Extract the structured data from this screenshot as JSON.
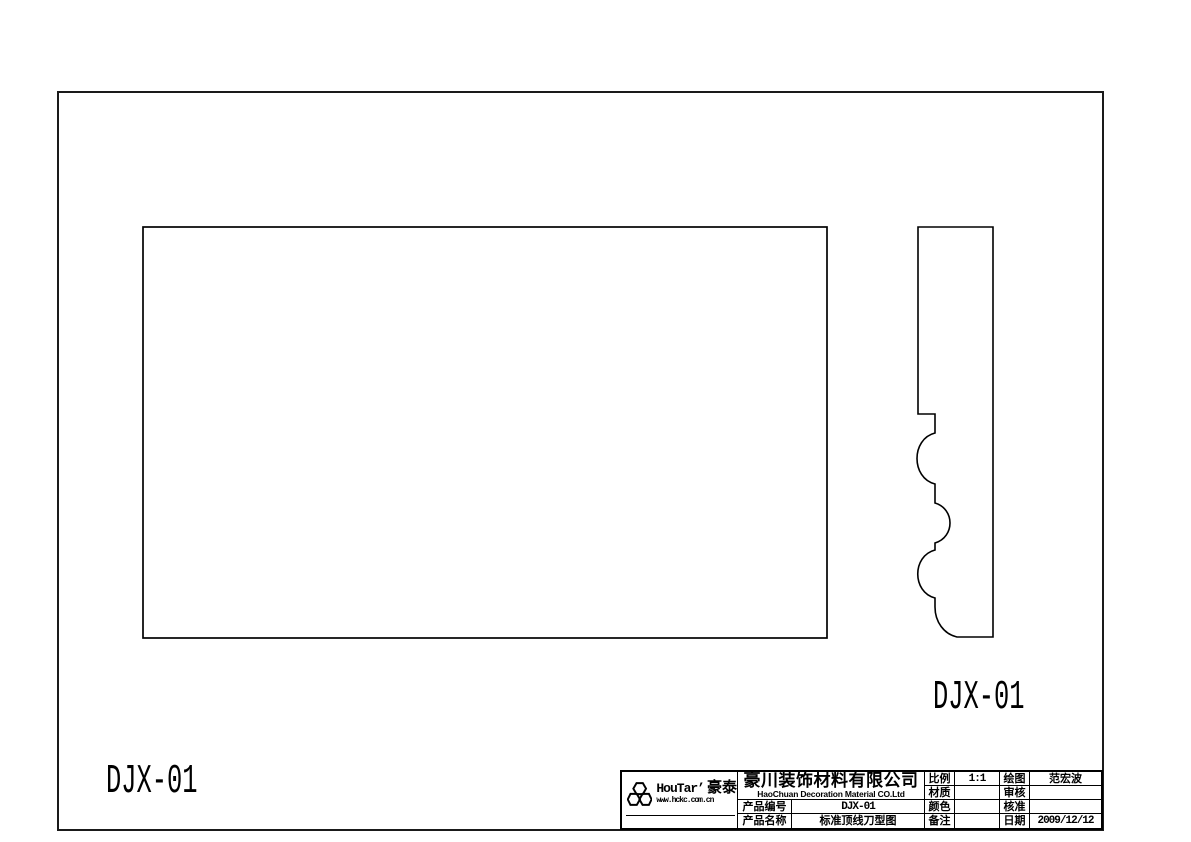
{
  "page": {
    "background": "#ffffff",
    "line_color": "#000000",
    "description": "CAD knife-profile drawing sheet for crown moulding DJX-01"
  },
  "views": {
    "front_view_label": "DJX-01",
    "profile_view_label": "DJX-01"
  },
  "title_block": {
    "logo": {
      "icon": "honeycomb-hexagons",
      "brand_en": "HouTar’",
      "brand_cn": "豪泰",
      "website": "www.hckc.com.cn"
    },
    "company": {
      "name_cn": "豪川装饰材料有限公司",
      "name_en": "HaoChuan Decoration Material CO.Ltd"
    },
    "fields": {
      "product_no_label": "产品编号",
      "product_no_value": "DJX-01",
      "product_name_label": "产品名称",
      "product_name_value": "标准顶线刀型图",
      "scale_label": "比例",
      "scale_value": "1:1",
      "material_label": "材质",
      "material_value": "",
      "color_label": "颜色",
      "color_value": "",
      "remarks_label": "备注",
      "remarks_value": "",
      "drawn_by_label": "绘图",
      "drawn_by_value": "范宏波",
      "checked_label": "审核",
      "checked_value": "",
      "approved_label": "核准",
      "approved_value": "",
      "date_label": "日期",
      "date_value": "2009/12/12"
    }
  }
}
